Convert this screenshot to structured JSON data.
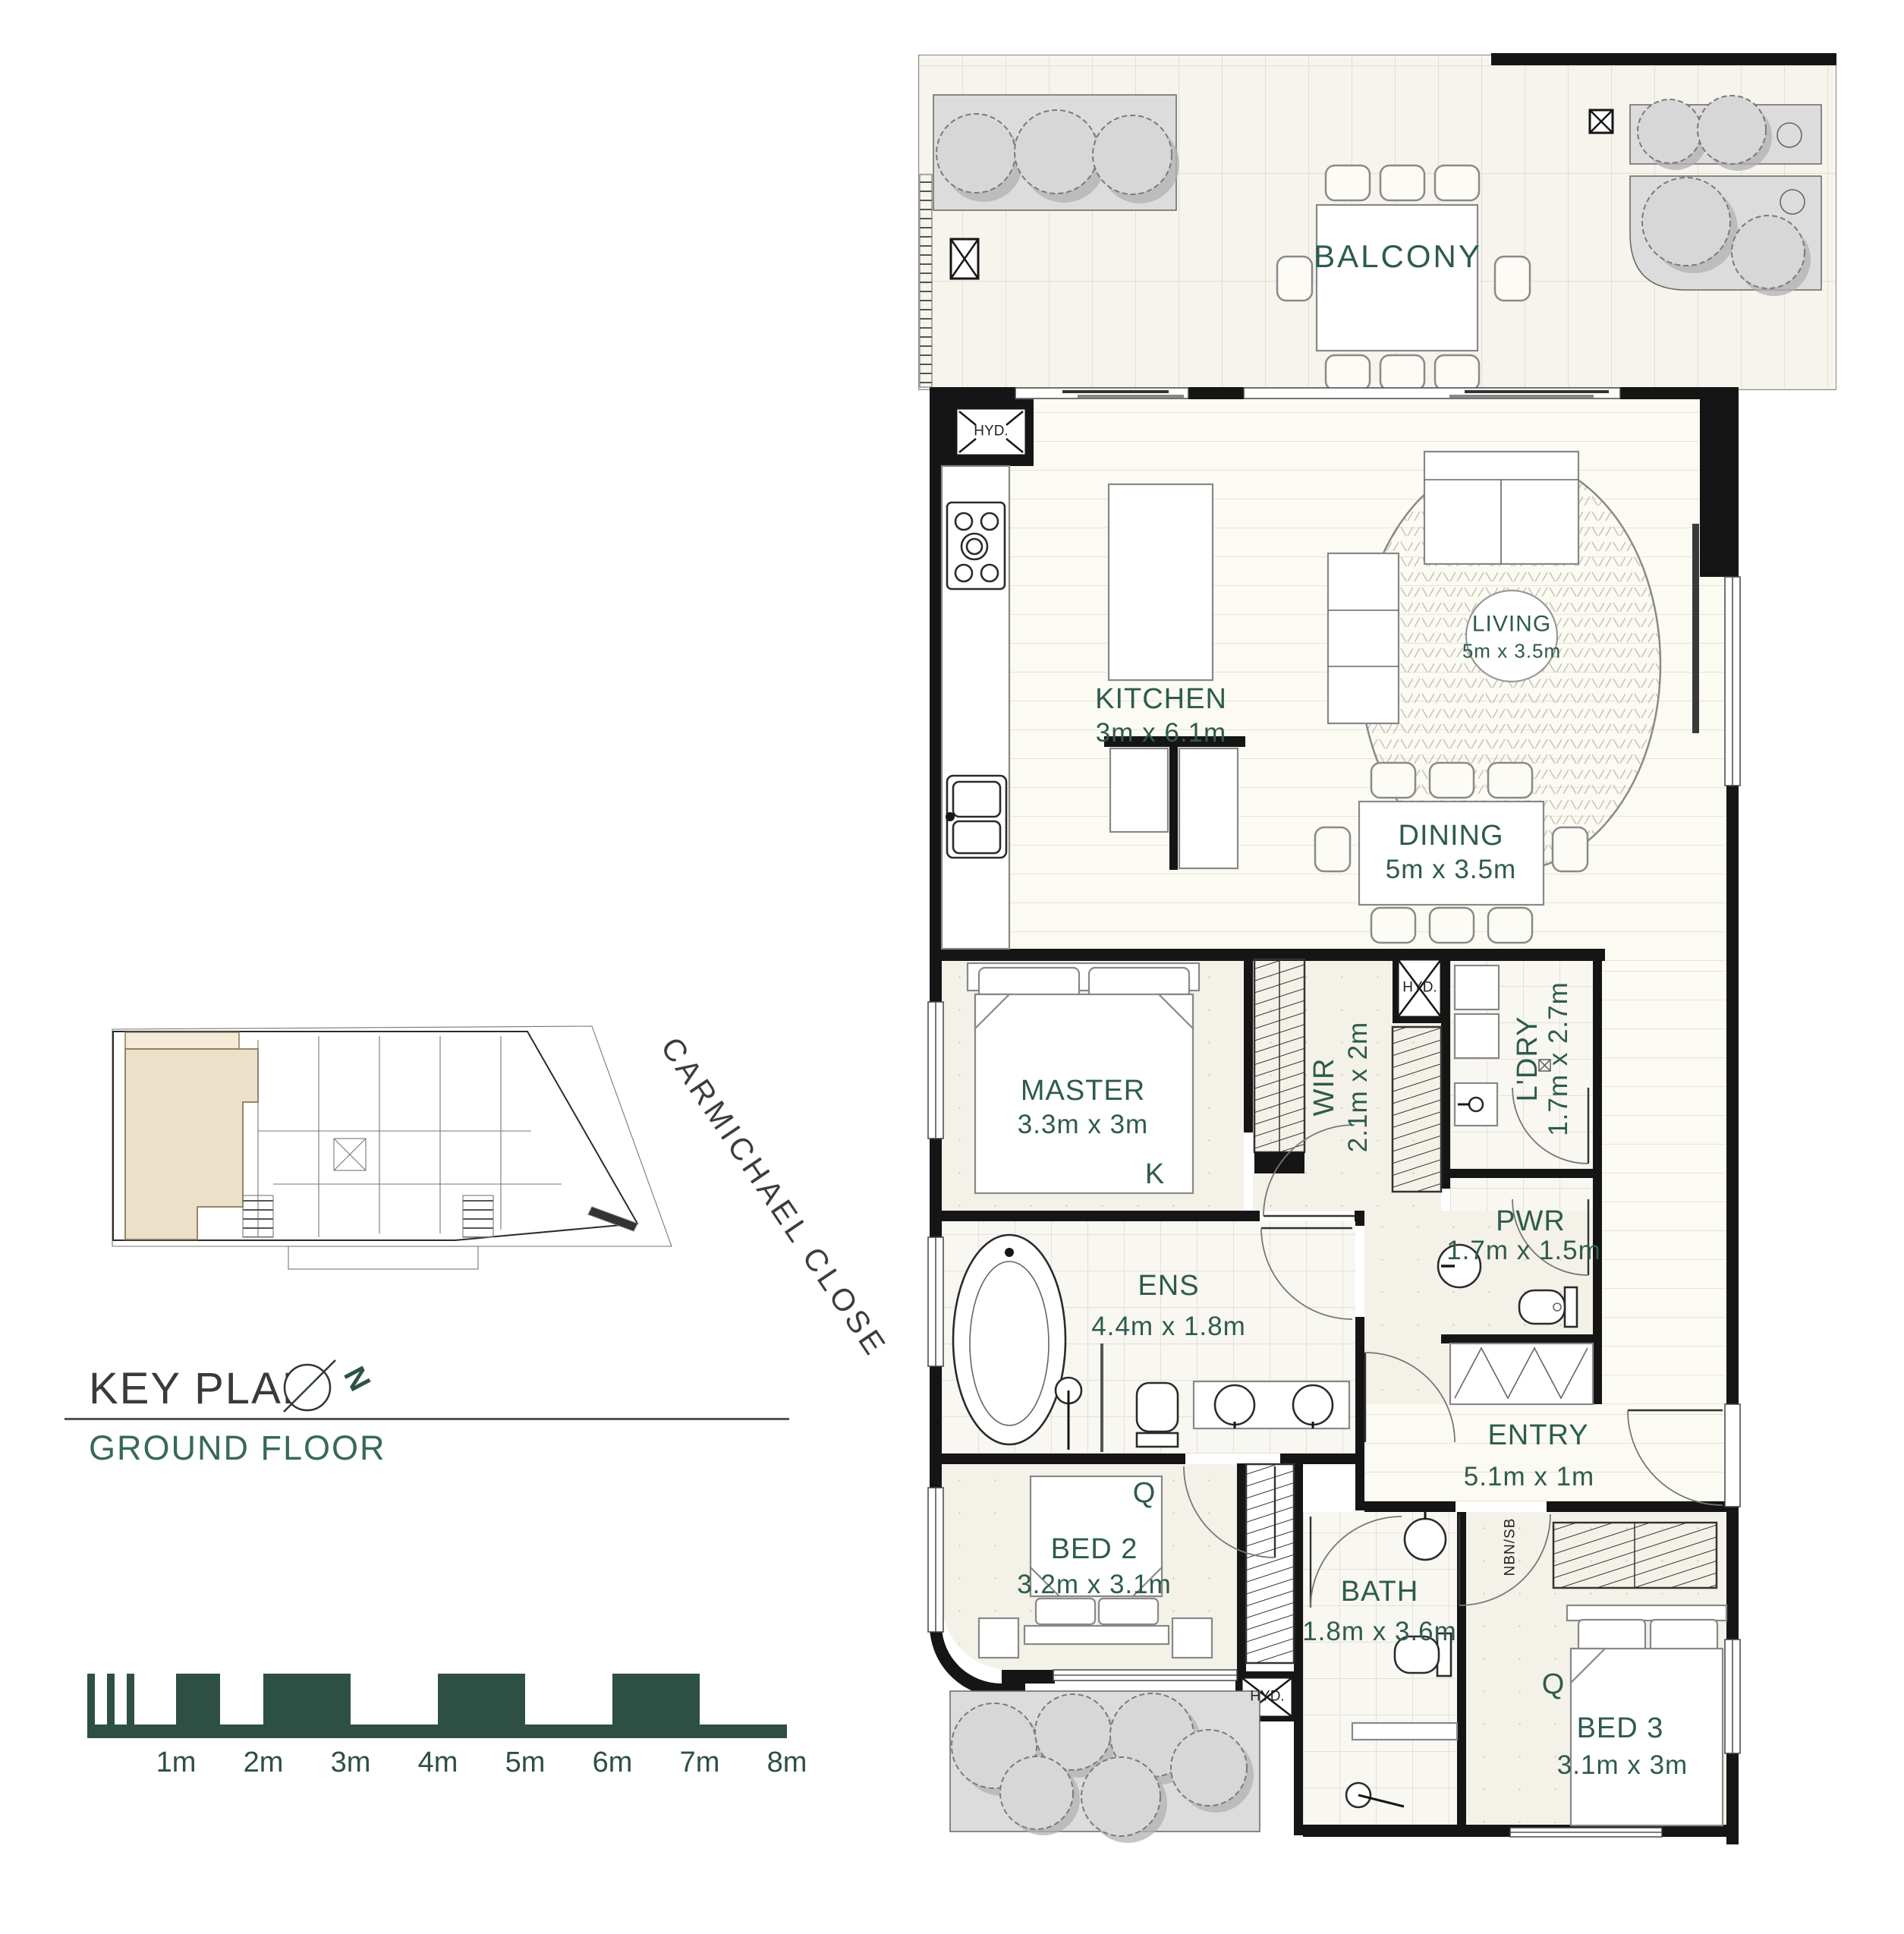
{
  "key_plan": {
    "title": "KEY PLAN",
    "subtitle": "GROUND FLOOR",
    "street": "CARMICHAEL CLOSE",
    "north": "N"
  },
  "scale_bar": {
    "labels": [
      "1m",
      "2m",
      "3m",
      "4m",
      "5m",
      "6m",
      "7m",
      "8m"
    ]
  },
  "rooms": {
    "balcony": {
      "name": "BALCONY"
    },
    "living": {
      "name": "LIVING",
      "dims": "5m x 3.5m"
    },
    "kitchen": {
      "name": "KITCHEN",
      "dims": "3m x 6.1m"
    },
    "dining": {
      "name": "DINING",
      "dims": "5m x 3.5m"
    },
    "master": {
      "name": "MASTER",
      "dims": "3.3m x 3m",
      "bed": "K"
    },
    "wir": {
      "name": "WIR",
      "dims": "2.1m x 2m"
    },
    "ldry": {
      "name": "L'DRY",
      "dims": "1.7m x 2.7m"
    },
    "pwr": {
      "name": "PWR",
      "dims": "1.7m x 1.5m"
    },
    "ens": {
      "name": "ENS",
      "dims": "4.4m x 1.8m"
    },
    "entry": {
      "name": "ENTRY",
      "dims": "5.1m x 1m"
    },
    "bed2": {
      "name": "BED 2",
      "dims": "3.2m x 3.1m",
      "bed": "Q"
    },
    "bath": {
      "name": "BATH",
      "dims": "1.8m x 3.6m"
    },
    "bed3": {
      "name": "BED 3",
      "dims": "3.1m x 3m",
      "bed": "Q"
    }
  },
  "markers": {
    "hyd": "HYD.",
    "nbn": "NBN/SB"
  },
  "colors": {
    "label_green": "#2e5b4e",
    "scale_green": "#2e4f44",
    "wall_black": "#151515",
    "keyplan_highlight": "#ece0c8"
  }
}
